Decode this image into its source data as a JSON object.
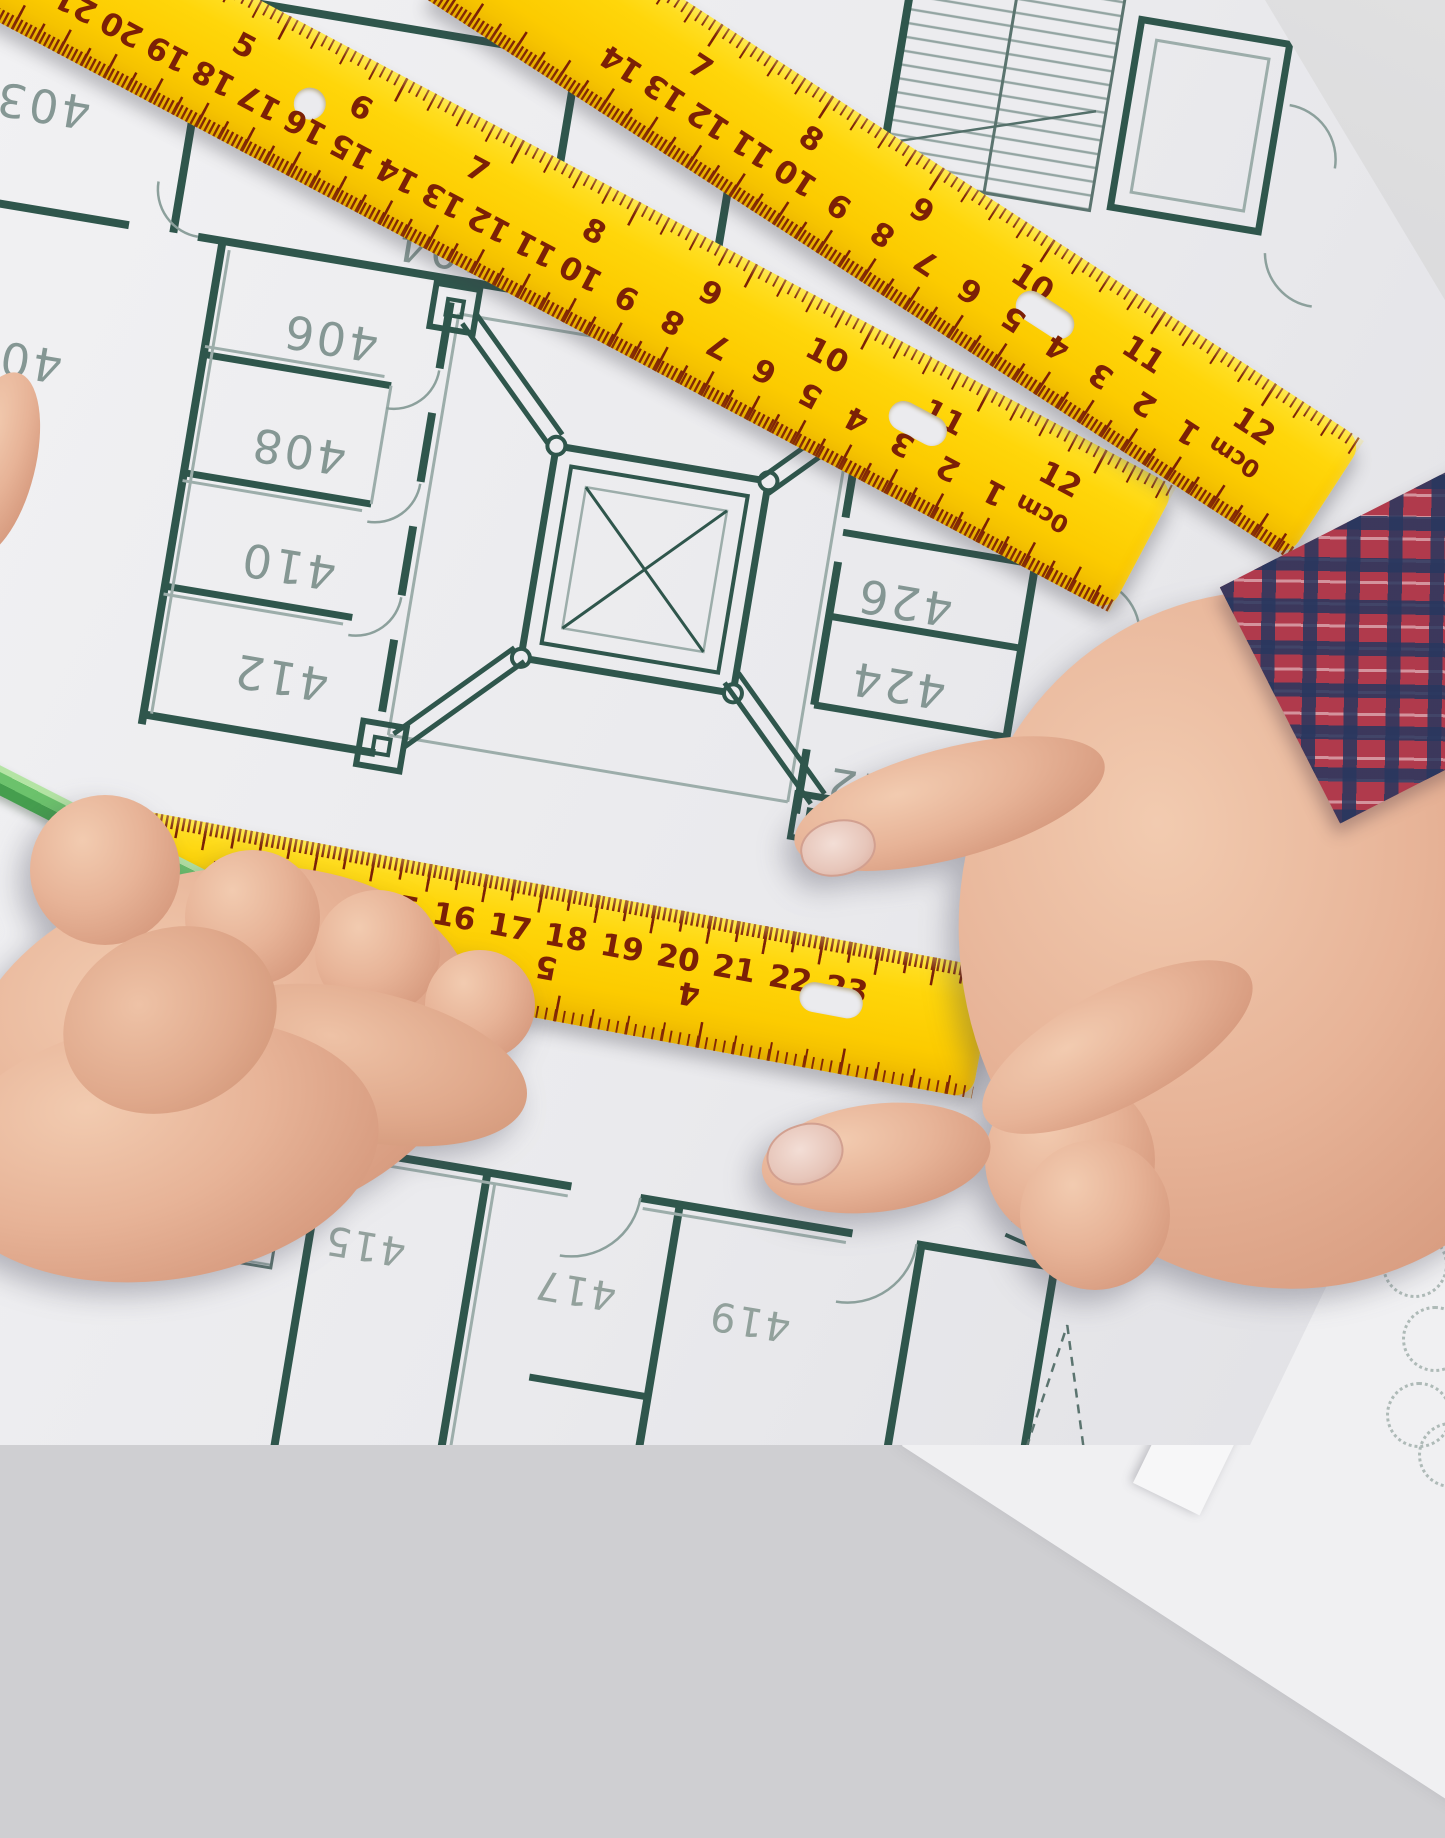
{
  "scene": {
    "description": "Hands measuring an architectural floor-plan blueprint with yellow rulers",
    "colors": {
      "ruler_yellow": "#ffd60a",
      "ruler_tick": "#7c2006",
      "wall_dark": "#2f564c",
      "wall_light": "#9cadaa",
      "paper": "#ebebed",
      "desk": "#d2d2d3",
      "skin": "#e7b397",
      "pencil_green": "#6cc26c",
      "plaid_red": "#b03a4c",
      "plaid_navy": "#2c3a5e"
    }
  },
  "rulers": {
    "unit_label": "0cm",
    "ruler_a": {
      "cm_numbers": [
        "22",
        "21",
        "20",
        "19",
        "18",
        "17",
        "16",
        "15",
        "14",
        "13",
        "12",
        "11",
        "10",
        "9",
        "8",
        "7",
        "6",
        "5",
        "4",
        "3",
        "2",
        "1",
        "0cm"
      ],
      "inch_numbers": [
        "5",
        "6",
        "7",
        "8",
        "9",
        "10",
        "11",
        "12"
      ]
    },
    "ruler_b": {
      "cm_numbers": [
        "14",
        "13",
        "12",
        "11",
        "10",
        "9",
        "8",
        "7",
        "6",
        "5",
        "4",
        "3",
        "2",
        "1",
        "0cm"
      ],
      "inch_numbers": [
        "7",
        "8",
        "9",
        "10",
        "11",
        "12"
      ]
    },
    "ruler_c": {
      "cm_numbers": [
        "12",
        "13",
        "14",
        "15",
        "16",
        "17",
        "18",
        "19",
        "20",
        "21",
        "22",
        "23"
      ],
      "inch_numbers": [
        "7",
        "6",
        "5",
        "4"
      ]
    }
  },
  "blueprint": {
    "rooms": {
      "r403": "403",
      "r404": "404",
      "r402": "402",
      "r40partial": "40",
      "r406": "406",
      "r408": "408",
      "r410": "410",
      "r412": "412",
      "r426": "426",
      "r424": "424",
      "r422": "422",
      "r413": "413",
      "r415": "415",
      "r417": "417",
      "r419": "419"
    }
  }
}
